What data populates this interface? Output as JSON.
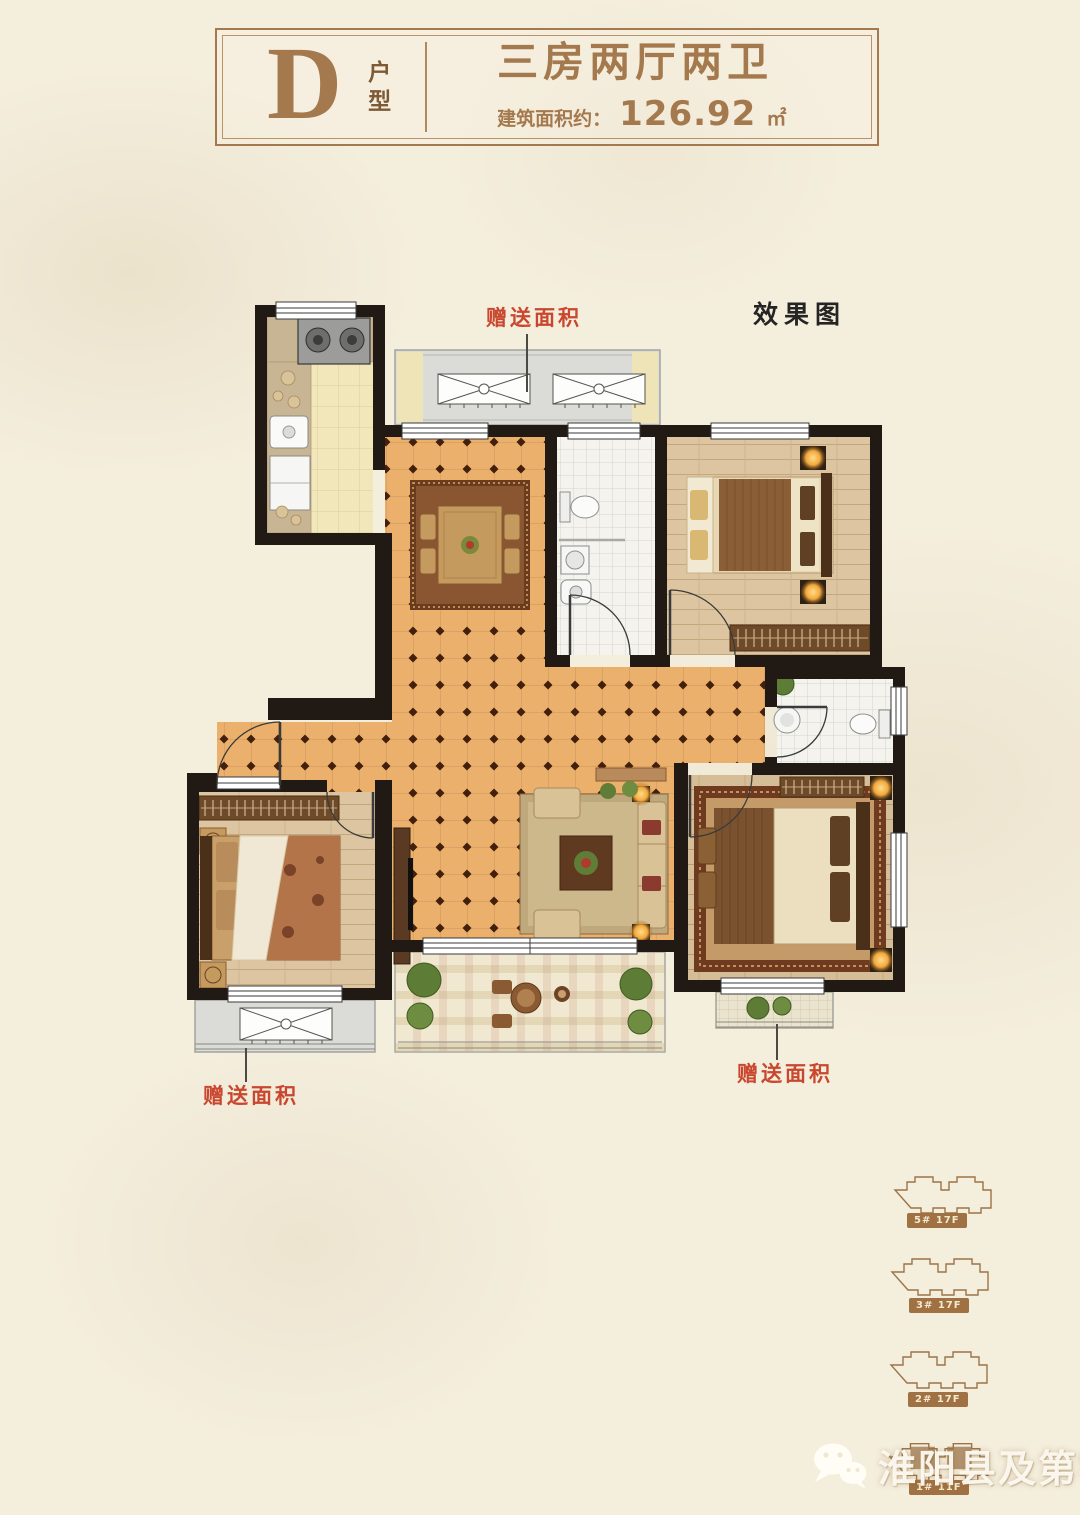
{
  "page": {
    "background": "#f4eedd"
  },
  "header": {
    "type_letter": "D",
    "type_suffix": [
      "户",
      "型"
    ],
    "title": "三房两厅两卫",
    "area_label": "建筑面积约：",
    "area_value": "126.92",
    "area_unit": "㎡",
    "accent_color": "#a5794e"
  },
  "plan": {
    "render_tag": "效果图",
    "gift_labels": {
      "top": "赠送面积",
      "bottom_left": "赠送面积",
      "bottom_right": "赠送面积"
    },
    "label_color": "#c8472e",
    "wall_color": "#211a14",
    "floor_color": "#ecb06d"
  },
  "site_buildings": [
    {
      "label": "5# 17F"
    },
    {
      "label": "3# 17F"
    },
    {
      "label": "2# 17F"
    },
    {
      "label": "1# 11F"
    }
  ],
  "watermark": {
    "icon": "wechat-icon",
    "text": "淮阳县及第学府"
  }
}
